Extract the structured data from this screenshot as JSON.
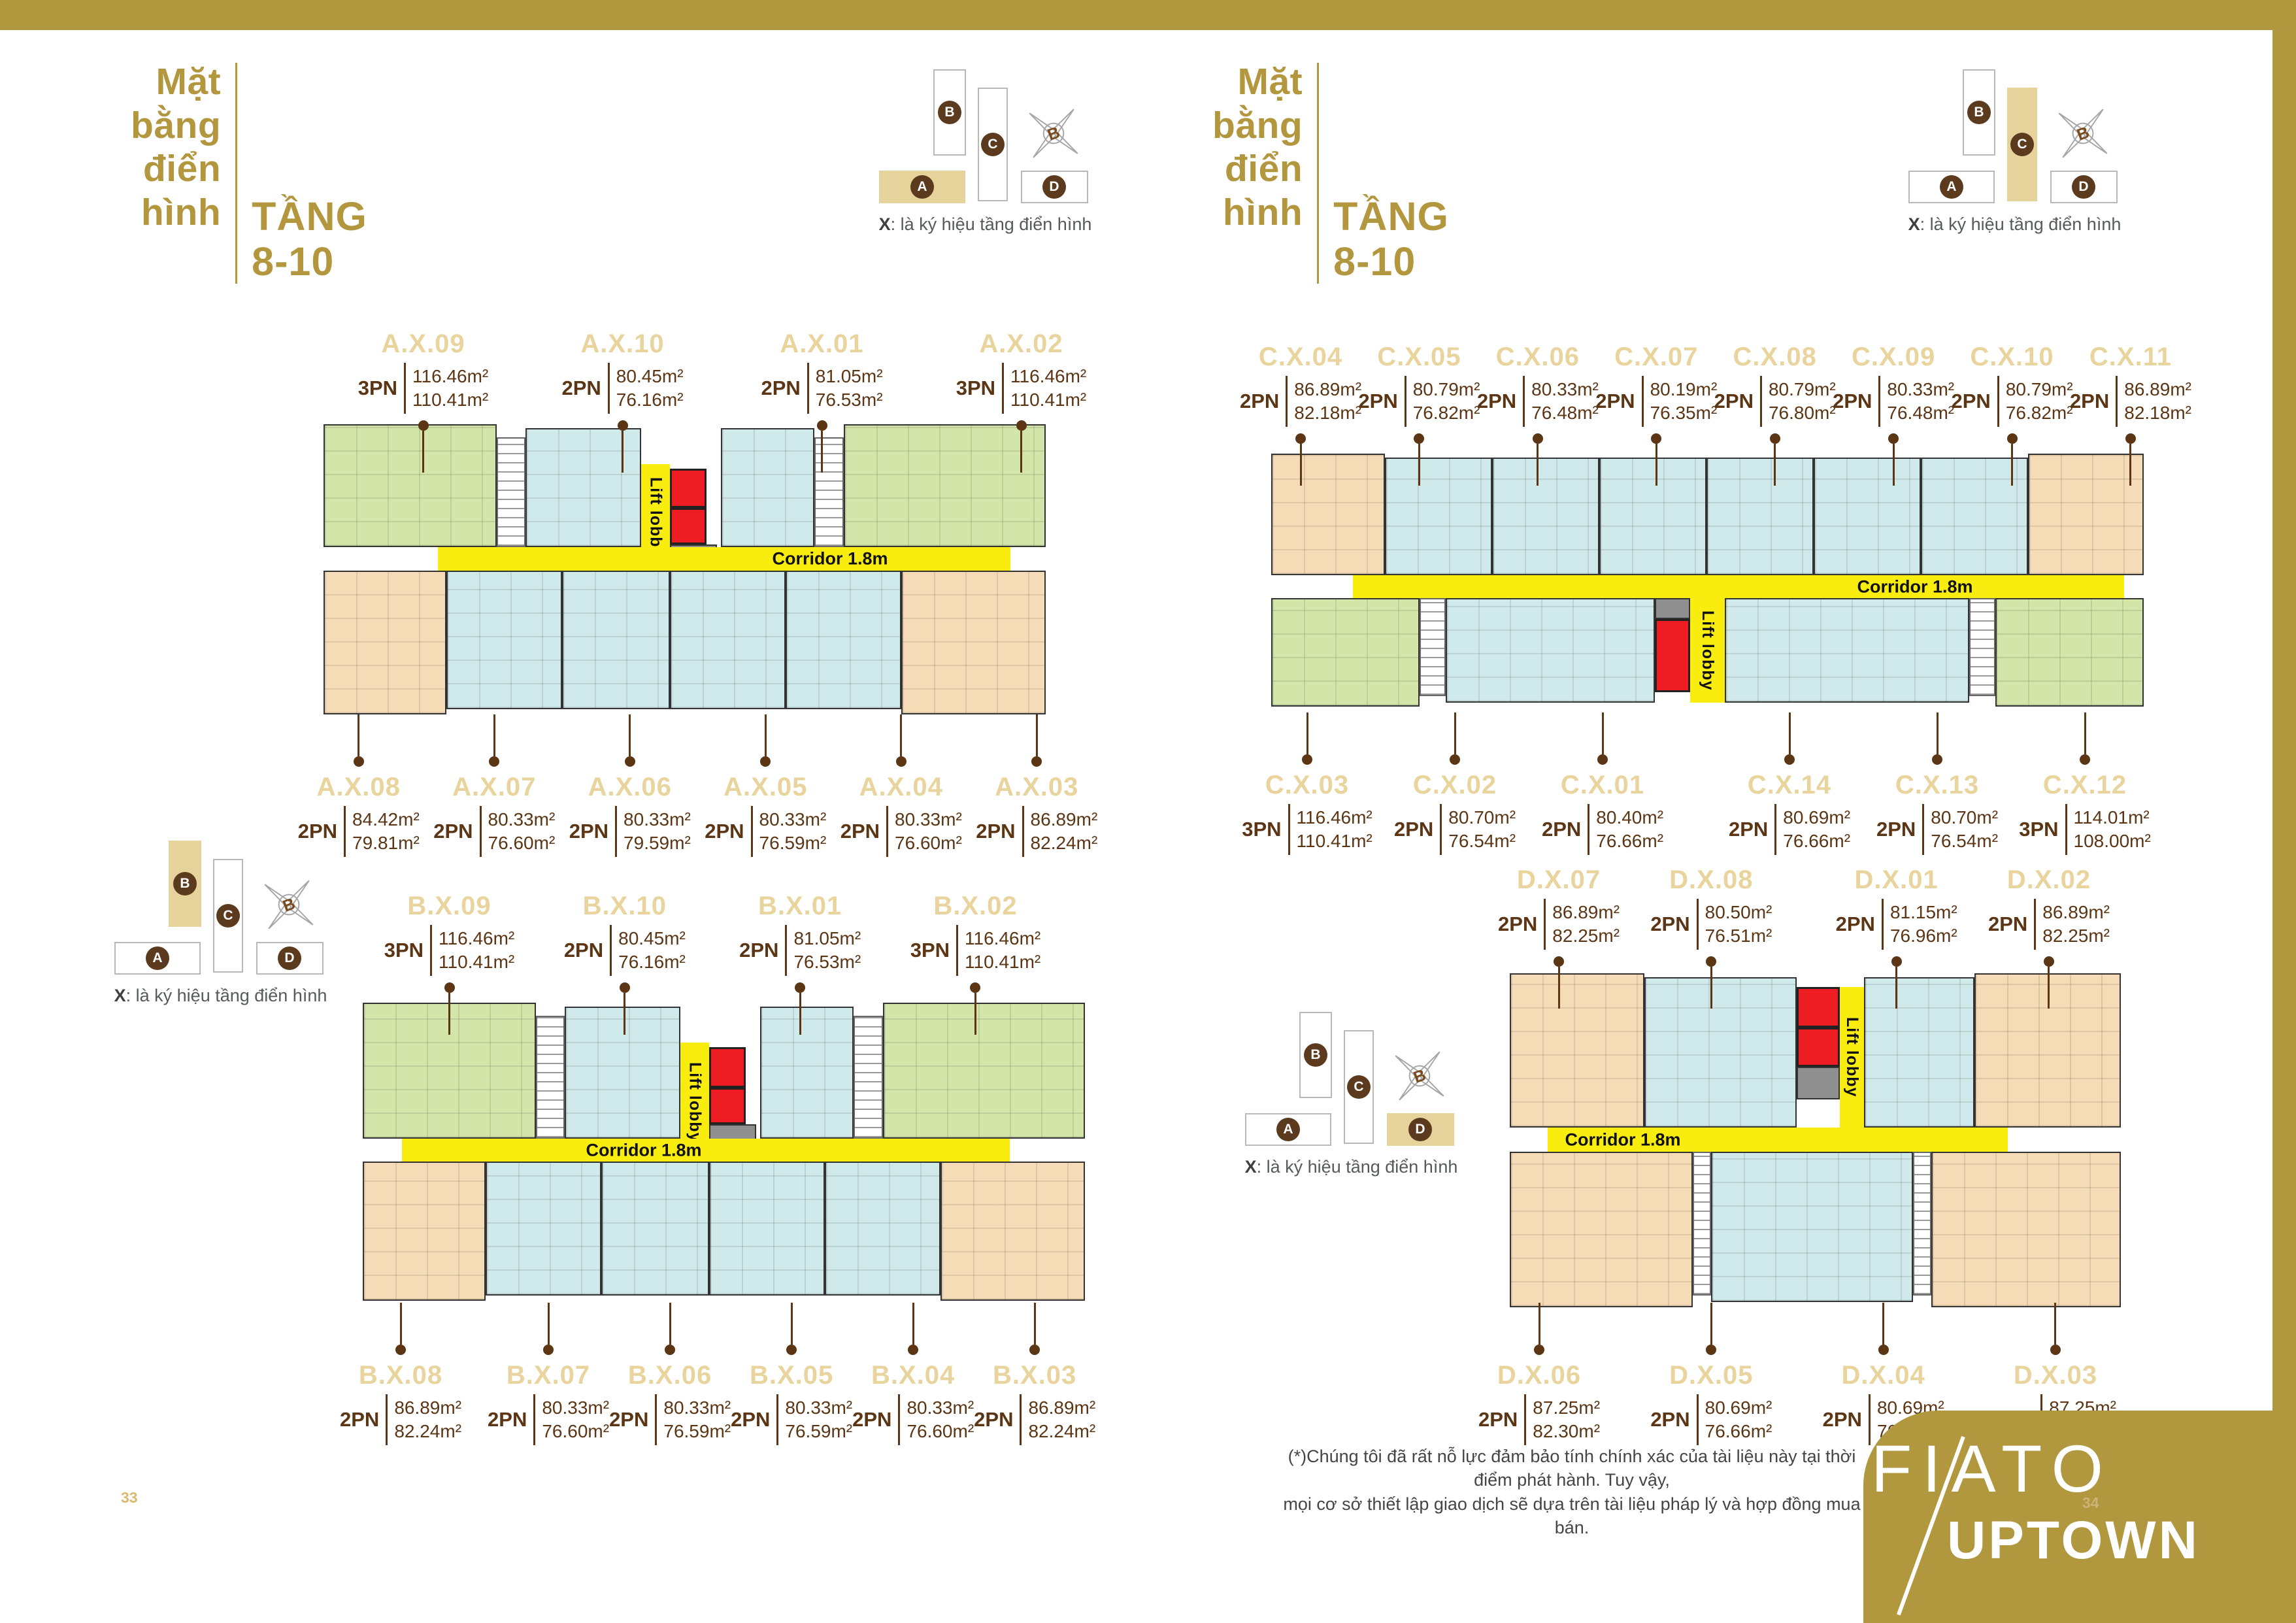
{
  "page": {
    "left_page_number": "33",
    "right_page_number": "34",
    "footnote": "(*)Chúng tôi đã rất nỗ lực đảm bảo tính chính xác của tài liệu này tại thời điểm phát hành. Tuy vậy,\nmọi cơ sở thiết lập giao dịch sẽ dựa trên tài liệu pháp lý và hợp đồng mua bán."
  },
  "header": {
    "title": "Mặt\nbằng\nđiển\nhình",
    "subtitle": "TẦNG\n8-10"
  },
  "key_plan": {
    "block_a": "A",
    "block_b": "B",
    "block_c": "C",
    "block_d": "D",
    "compass_north": "B",
    "caption_x": "X",
    "caption_rest": ": là ký hiệu tầng điển hình"
  },
  "plan_labels": {
    "corridor": "Corridor 1.8m",
    "lift": "Lift lobby"
  },
  "logo": {
    "line1": "FIATO",
    "line2": "UPTOWN"
  },
  "colors": {
    "gold": "#b1973e",
    "gold_light": "#e7d39b",
    "brown_text": "#5b3514",
    "unit_green": "#d3e5a9",
    "unit_blue": "#d0e9ea",
    "unit_peach": "#f6dcb6",
    "corridor_yellow": "#f8ed0f",
    "lift_red": "#ee1d23",
    "core_gray": "#8f8f8f"
  },
  "plans": {
    "a": {
      "top": [
        {
          "id": "A.X.09",
          "pn": "3PN",
          "a1": "116.46m²",
          "a2": "110.41m²"
        },
        {
          "id": "A.X.10",
          "pn": "2PN",
          "a1": "80.45m²",
          "a2": "76.16m²"
        },
        {
          "id": "A.X.01",
          "pn": "2PN",
          "a1": "81.05m²",
          "a2": "76.53m²"
        },
        {
          "id": "A.X.02",
          "pn": "3PN",
          "a1": "116.46m²",
          "a2": "110.41m²"
        }
      ],
      "bottom": [
        {
          "id": "A.X.08",
          "pn": "2PN",
          "a1": "84.42m²",
          "a2": "79.81m²"
        },
        {
          "id": "A.X.07",
          "pn": "2PN",
          "a1": "80.33m²",
          "a2": "76.60m²"
        },
        {
          "id": "A.X.06",
          "pn": "2PN",
          "a1": "80.33m²",
          "a2": "79.59m²"
        },
        {
          "id": "A.X.05",
          "pn": "2PN",
          "a1": "80.33m²",
          "a2": "76.59m²"
        },
        {
          "id": "A.X.04",
          "pn": "2PN",
          "a1": "80.33m²",
          "a2": "76.60m²"
        },
        {
          "id": "A.X.03",
          "pn": "2PN",
          "a1": "86.89m²",
          "a2": "82.24m²"
        }
      ]
    },
    "c": {
      "top": [
        {
          "id": "C.X.04",
          "pn": "2PN",
          "a1": "86.89m²",
          "a2": "82.18m²"
        },
        {
          "id": "C.X.05",
          "pn": "2PN",
          "a1": "80.79m²",
          "a2": "76.82m²"
        },
        {
          "id": "C.X.06",
          "pn": "2PN",
          "a1": "80.33m²",
          "a2": "76.48m²"
        },
        {
          "id": "C.X.07",
          "pn": "2PN",
          "a1": "80.19m²",
          "a2": "76.35m²"
        },
        {
          "id": "C.X.08",
          "pn": "2PN",
          "a1": "80.79m²",
          "a2": "76.80m²"
        },
        {
          "id": "C.X.09",
          "pn": "2PN",
          "a1": "80.33m²",
          "a2": "76.48m²"
        },
        {
          "id": "C.X.10",
          "pn": "2PN",
          "a1": "80.79m²",
          "a2": "76.82m²"
        },
        {
          "id": "C.X.11",
          "pn": "2PN",
          "a1": "86.89m²",
          "a2": "82.18m²"
        }
      ],
      "bottom": [
        {
          "id": "C.X.03",
          "pn": "3PN",
          "a1": "116.46m²",
          "a2": "110.41m²"
        },
        {
          "id": "C.X.02",
          "pn": "2PN",
          "a1": "80.70m²",
          "a2": "76.54m²"
        },
        {
          "id": "C.X.01",
          "pn": "2PN",
          "a1": "80.40m²",
          "a2": "76.66m²"
        },
        {
          "id": "C.X.14",
          "pn": "2PN",
          "a1": "80.69m²",
          "a2": "76.66m²"
        },
        {
          "id": "C.X.13",
          "pn": "2PN",
          "a1": "80.70m²",
          "a2": "76.54m²"
        },
        {
          "id": "C.X.12",
          "pn": "3PN",
          "a1": "114.01m²",
          "a2": "108.00m²"
        }
      ]
    },
    "b": {
      "top": [
        {
          "id": "B.X.09",
          "pn": "3PN",
          "a1": "116.46m²",
          "a2": "110.41m²"
        },
        {
          "id": "B.X.10",
          "pn": "2PN",
          "a1": "80.45m²",
          "a2": "76.16m²"
        },
        {
          "id": "B.X.01",
          "pn": "2PN",
          "a1": "81.05m²",
          "a2": "76.53m²"
        },
        {
          "id": "B.X.02",
          "pn": "3PN",
          "a1": "116.46m²",
          "a2": "110.41m²"
        }
      ],
      "bottom": [
        {
          "id": "B.X.08",
          "pn": "2PN",
          "a1": "86.89m²",
          "a2": "82.24m²"
        },
        {
          "id": "B.X.07",
          "pn": "2PN",
          "a1": "80.33m²",
          "a2": "76.60m²"
        },
        {
          "id": "B.X.06",
          "pn": "2PN",
          "a1": "80.33m²",
          "a2": "76.59m²"
        },
        {
          "id": "B.X.05",
          "pn": "2PN",
          "a1": "80.33m²",
          "a2": "76.59m²"
        },
        {
          "id": "B.X.04",
          "pn": "2PN",
          "a1": "80.33m²",
          "a2": "76.60m²"
        },
        {
          "id": "B.X.03",
          "pn": "2PN",
          "a1": "86.89m²",
          "a2": "82.24m²"
        }
      ]
    },
    "d": {
      "top": [
        {
          "id": "D.X.07",
          "pn": "2PN",
          "a1": "86.89m²",
          "a2": "82.25m²"
        },
        {
          "id": "D.X.08",
          "pn": "2PN",
          "a1": "80.50m²",
          "a2": "76.51m²"
        },
        {
          "id": "D.X.01",
          "pn": "2PN",
          "a1": "81.15m²",
          "a2": "76.96m²"
        },
        {
          "id": "D.X.02",
          "pn": "2PN",
          "a1": "86.89m²",
          "a2": "82.25m²"
        }
      ],
      "bottom": [
        {
          "id": "D.X.06",
          "pn": "2PN",
          "a1": "87.25m²",
          "a2": "82.30m²"
        },
        {
          "id": "D.X.05",
          "pn": "2PN",
          "a1": "80.69m²",
          "a2": "76.66m²"
        },
        {
          "id": "D.X.04",
          "pn": "2PN",
          "a1": "80.69m²",
          "a2": "76.66m²"
        },
        {
          "id": "D.X.03",
          "pn": "2PN",
          "a1": "87.25m²",
          "a2": "82.30m²"
        }
      ]
    }
  }
}
